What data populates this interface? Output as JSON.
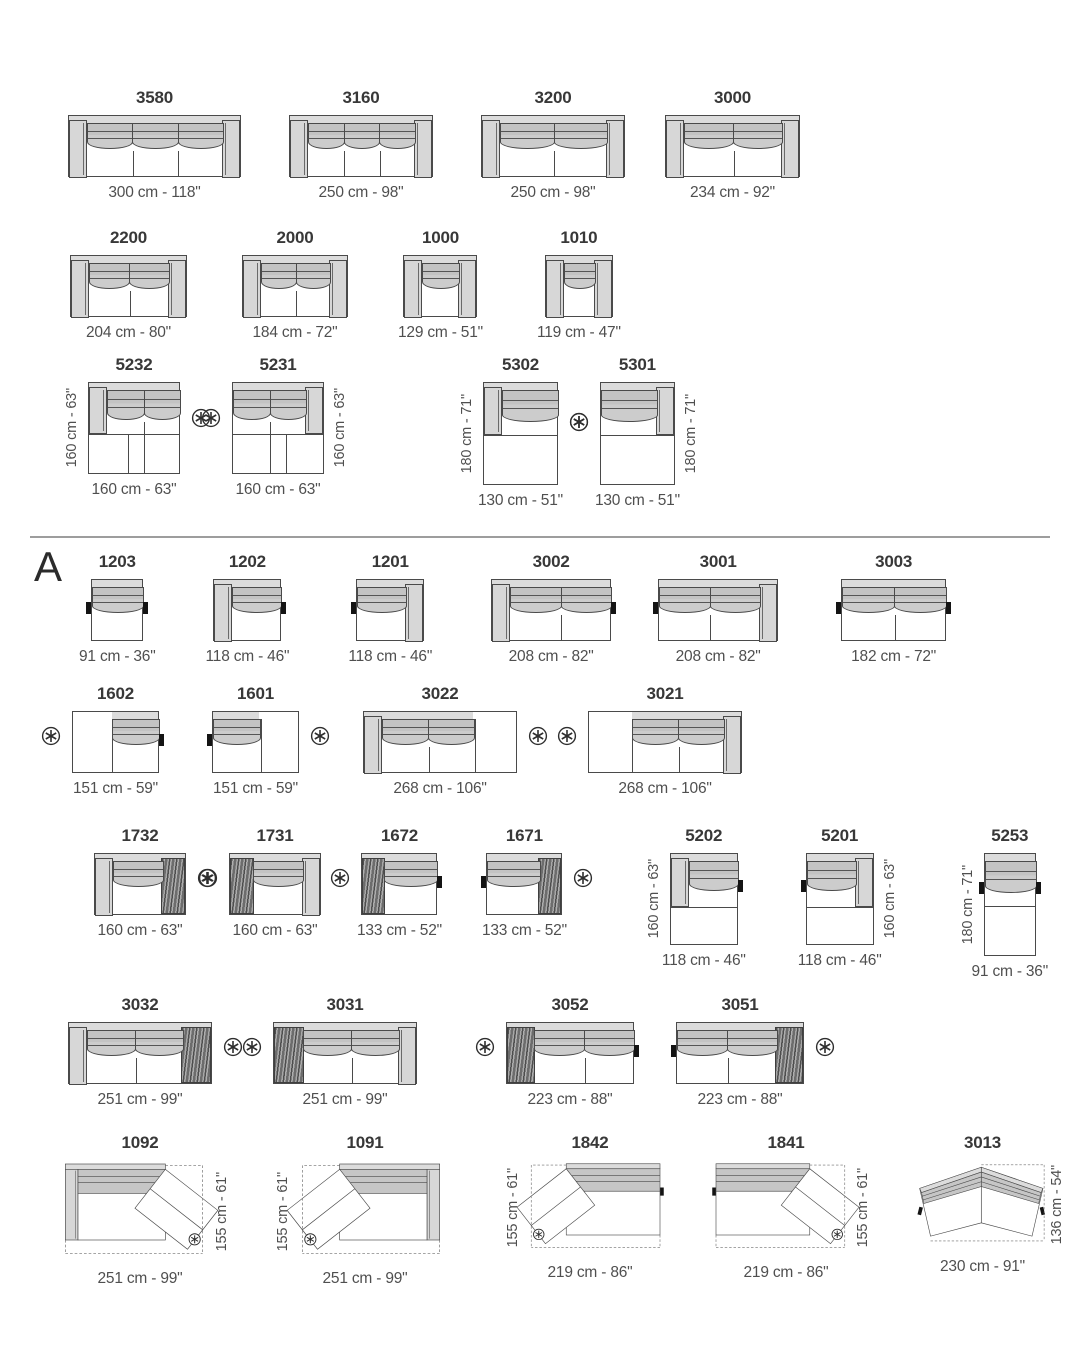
{
  "sheet": {
    "section_label": "A",
    "icons": {
      "note": "circled-asterisk"
    },
    "colors": {
      "outline": "#4a4a4a",
      "rail": "#dcdcdc",
      "arm": "#d7d7d7",
      "cushion": "#c6c6c6",
      "texture": "#8f8f8f",
      "tab": "#141414",
      "dim_text": "#4f4f4f",
      "title_text": "#383838",
      "divider": "#9d9d9d",
      "dashed": "#6f6f6f"
    }
  },
  "rows": [
    {
      "top": 88,
      "modules": [
        {
          "model": "3580",
          "dim": "300 cm - 118\"",
          "w": 300,
          "segs": 3,
          "armL": 1,
          "armR": 1,
          "ml": 68
        },
        {
          "model": "3160",
          "dim": "250 cm - 98\"",
          "w": 250,
          "segs": 3,
          "armL": 1,
          "armR": 1,
          "ml": 48
        },
        {
          "model": "3200",
          "dim": "250 cm - 98\"",
          "w": 250,
          "segs": 2,
          "armL": 1,
          "armR": 1,
          "ml": 48
        },
        {
          "model": "3000",
          "dim": "234 cm - 92\"",
          "w": 234,
          "segs": 2,
          "armL": 1,
          "armR": 1,
          "ml": 40
        }
      ]
    },
    {
      "top": 228,
      "modules": [
        {
          "model": "2200",
          "dim": "204 cm - 80\"",
          "w": 204,
          "segs": 2,
          "armL": 1,
          "armR": 1,
          "ml": 70
        },
        {
          "model": "2000",
          "dim": "184 cm - 72\"",
          "w": 184,
          "segs": 2,
          "armL": 1,
          "armR": 1,
          "ml": 55
        },
        {
          "model": "1000",
          "dim": "129 cm - 51\"",
          "w": 129,
          "segs": 1,
          "armL": 1,
          "armR": 1,
          "ml": 50
        },
        {
          "model": "1010",
          "dim": "119 cm - 47\"",
          "w": 119,
          "segs": 1,
          "armL": 1,
          "armR": 1,
          "ml": 54
        }
      ]
    },
    {
      "top": 355,
      "modules": [
        {
          "model": "5232",
          "dim": "160 cm - 63\"",
          "w": 160,
          "d": 160,
          "segs": 2,
          "armL": "part",
          "seam": 0.55,
          "lowdiv": 0.42,
          "vdim": "160 cm - 63\"",
          "vside": "l",
          "ast": "r",
          "ml": 88
        },
        {
          "model": "5231",
          "dim": "160 cm - 63\"",
          "w": 160,
          "d": 160,
          "segs": 2,
          "armR": "part",
          "seam": 0.55,
          "lowdiv": 0.58,
          "vdim": "160 cm - 63\"",
          "vside": "r",
          "ast": "l",
          "ml": 52
        },
        {
          "model": "5302",
          "dim": "130 cm - 51\"",
          "w": 130,
          "d": 180,
          "segs": 1,
          "armL": "part",
          "seam": 0.5,
          "vdim": "180 cm - 71\"",
          "vside": "l",
          "ast": "r",
          "ml": 154
        },
        {
          "model": "5301",
          "dim": "130 cm - 51\"",
          "w": 130,
          "d": 180,
          "segs": 1,
          "armR": "part",
          "seam": 0.5,
          "vdim": "180 cm - 71\"",
          "vside": "r",
          "ast": "l",
          "ml": 32
        }
      ]
    },
    {
      "top": 552,
      "modules": [
        {
          "model": "1203",
          "dim": "91 cm - 36\"",
          "w": 91,
          "segs": 1,
          "tabL": 1,
          "tabR": 1,
          "ml": 79
        },
        {
          "model": "1202",
          "dim": "118 cm - 46\"",
          "w": 118,
          "segs": 1,
          "armL": 1,
          "tabR": 1,
          "ml": 50
        },
        {
          "model": "1201",
          "dim": "118 cm - 46\"",
          "w": 118,
          "segs": 1,
          "armR": 1,
          "tabL": 1,
          "ml": 59
        },
        {
          "model": "3002",
          "dim": "208 cm - 82\"",
          "w": 208,
          "segs": 2,
          "armL": 1,
          "tabR": 1,
          "ml": 59
        },
        {
          "model": "3001",
          "dim": "208 cm - 82\"",
          "w": 208,
          "segs": 2,
          "armR": 1,
          "tabL": 1,
          "ml": 47
        },
        {
          "model": "3003",
          "dim": "182 cm - 72\"",
          "w": 182,
          "segs": 2,
          "tabL": 1,
          "tabR": 1,
          "ml": 63
        }
      ]
    },
    {
      "top": 684,
      "modules": [
        {
          "model": "1602",
          "dim": "151 cm - 59\"",
          "w": 151,
          "segs": 1,
          "band": [
            0.45,
            null
          ],
          "odiv": 0.45,
          "tabR": 1,
          "ast": "l",
          "ml": 72
        },
        {
          "model": "1601",
          "dim": "151 cm - 59\"",
          "w": 151,
          "segs": 1,
          "band": [
            null,
            0.55
          ],
          "odiv": 0.55,
          "tabL": 1,
          "ast": "r",
          "ml": 53
        },
        {
          "model": "3022",
          "dim": "268 cm - 106\"",
          "w": 268,
          "segs": 2,
          "armL": 1,
          "band": [
            null,
            0.72
          ],
          "odiv": 0.72,
          "ast": "r",
          "ml": 64
        },
        {
          "model": "3021",
          "dim": "268 cm - 106\"",
          "w": 268,
          "segs": 2,
          "armR": 1,
          "band": [
            0.28,
            null
          ],
          "odiv": 0.28,
          "ast": "l",
          "ml": 71
        }
      ]
    },
    {
      "top": 826,
      "modules": [
        {
          "model": "1732",
          "dim": "160 cm - 63\"",
          "w": 160,
          "segs": 1,
          "armL": 1,
          "texR": 0.26,
          "ast": "r",
          "ml": 94
        },
        {
          "model": "1731",
          "dim": "160 cm - 63\"",
          "w": 160,
          "segs": 1,
          "armR": 1,
          "texL": 0.26,
          "ast": "l",
          "ml": 43
        },
        {
          "model": "1672",
          "dim": "133 cm - 52\"",
          "w": 133,
          "segs": 1,
          "texL": 0.3,
          "tabR": 1,
          "ast": "l",
          "ml": 36
        },
        {
          "model": "1671",
          "dim": "133 cm - 52\"",
          "w": 133,
          "segs": 1,
          "texR": 0.3,
          "tabL": 1,
          "ast": "r",
          "ml": 40
        },
        {
          "model": "5202",
          "dim": "118 cm - 46\"",
          "w": 118,
          "d": 160,
          "segs": 1,
          "armL": "part",
          "seam": 0.58,
          "tabR": 1,
          "vdim": "160 cm - 63\"",
          "vside": "l",
          "ml": 95
        },
        {
          "model": "5201",
          "dim": "118 cm - 46\"",
          "w": 118,
          "d": 160,
          "segs": 1,
          "armR": "part",
          "seam": 0.58,
          "tabL": 1,
          "vdim": "160 cm - 63\"",
          "vside": "r",
          "ml": 52
        },
        {
          "model": "5253",
          "dim": "91 cm - 36\"",
          "w": 91,
          "d": 180,
          "segs": 1,
          "seam": 0.5,
          "tabL": 1,
          "tabR": 1,
          "vdim": "180 cm - 71\"",
          "vside": "l",
          "ml": 90
        }
      ]
    },
    {
      "top": 995,
      "modules": [
        {
          "model": "3032",
          "dim": "251 cm - 99\"",
          "w": 251,
          "segs": 2,
          "armL": 1,
          "texR": 0.21,
          "ast": "r",
          "ml": 68
        },
        {
          "model": "3031",
          "dim": "251 cm - 99\"",
          "w": 251,
          "segs": 2,
          "armR": 1,
          "texL": 0.21,
          "ast": "l",
          "ml": 61
        },
        {
          "model": "3052",
          "dim": "223 cm - 88\"",
          "w": 223,
          "segs": 2,
          "texL": 0.22,
          "tabR": 1,
          "ast": "l",
          "ml": 89
        },
        {
          "model": "3051",
          "dim": "223 cm - 88\"",
          "w": 223,
          "segs": 2,
          "tabL": 1,
          "texR": 0.22,
          "ast": "r",
          "ml": 42
        }
      ]
    },
    {
      "top": 1133,
      "modules": [
        {
          "model": "1092",
          "type": "angled",
          "dim": "251 cm - 99\"",
          "vdim": "155 cm - 61\"",
          "vside": "r",
          "end": "arm",
          "flip": 0,
          "sw": 160,
          "ml": 60
        },
        {
          "model": "1091",
          "type": "angled",
          "dim": "251 cm - 99\"",
          "vdim": "155 cm - 61\"",
          "vside": "l",
          "end": "arm",
          "flip": 1,
          "sw": 160,
          "ml": 65
        },
        {
          "model": "1842",
          "type": "angled",
          "dim": "219 cm - 86\"",
          "vdim": "155 cm - 61\"",
          "vside": "l",
          "end": "tab",
          "flip": 1,
          "sw": 150,
          "ml": 70
        },
        {
          "model": "1841",
          "type": "angled",
          "dim": "219 cm - 86\"",
          "vdim": "155 cm - 61\"",
          "vside": "r",
          "end": "tab",
          "flip": 0,
          "sw": 150,
          "ml": 46
        },
        {
          "model": "3013",
          "type": "corner",
          "dim": "230 cm - 91\"",
          "vdim": "136 cm - 54\"",
          "vside": "r",
          "sw": 145,
          "ml": 49
        }
      ]
    }
  ]
}
